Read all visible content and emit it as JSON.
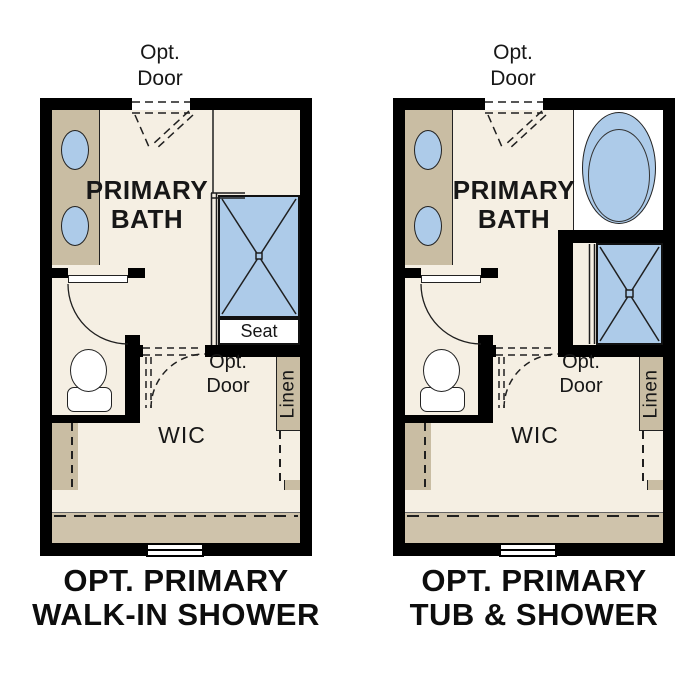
{
  "figure": {
    "type": "floor-plan-options-diagram"
  },
  "colors": {
    "wall": "#000000",
    "floor": "#f5efe3",
    "cabinet": "#c9bda3",
    "band": "#cfc3ab",
    "fixture-blue": "#adcbe9",
    "line": "#1f1f1f",
    "text": "#171717",
    "background": "#ffffff"
  },
  "plans": [
    {
      "name": "Walk-in shower option",
      "top_door": {
        "line1": "Opt.",
        "line2": "Door"
      },
      "room": {
        "line1": "PRIMARY",
        "line2": "BATH"
      },
      "seat": "Seat",
      "wic_door": {
        "line1": "Opt.",
        "line2": "Door"
      },
      "wic": "WIC",
      "linen": "Linen",
      "caption": {
        "line1": "OPT. PRIMARY",
        "line2": "WALK-IN SHOWER"
      }
    },
    {
      "name": "Tub and shower option",
      "top_door": {
        "line1": "Opt.",
        "line2": "Door"
      },
      "room": {
        "line1": "PRIMARY",
        "line2": "BATH"
      },
      "wic_door": {
        "line1": "Opt.",
        "line2": "Door"
      },
      "wic": "WIC",
      "linen": "Linen",
      "caption": {
        "line1": "OPT. PRIMARY",
        "line2": "TUB & SHOWER"
      }
    }
  ]
}
